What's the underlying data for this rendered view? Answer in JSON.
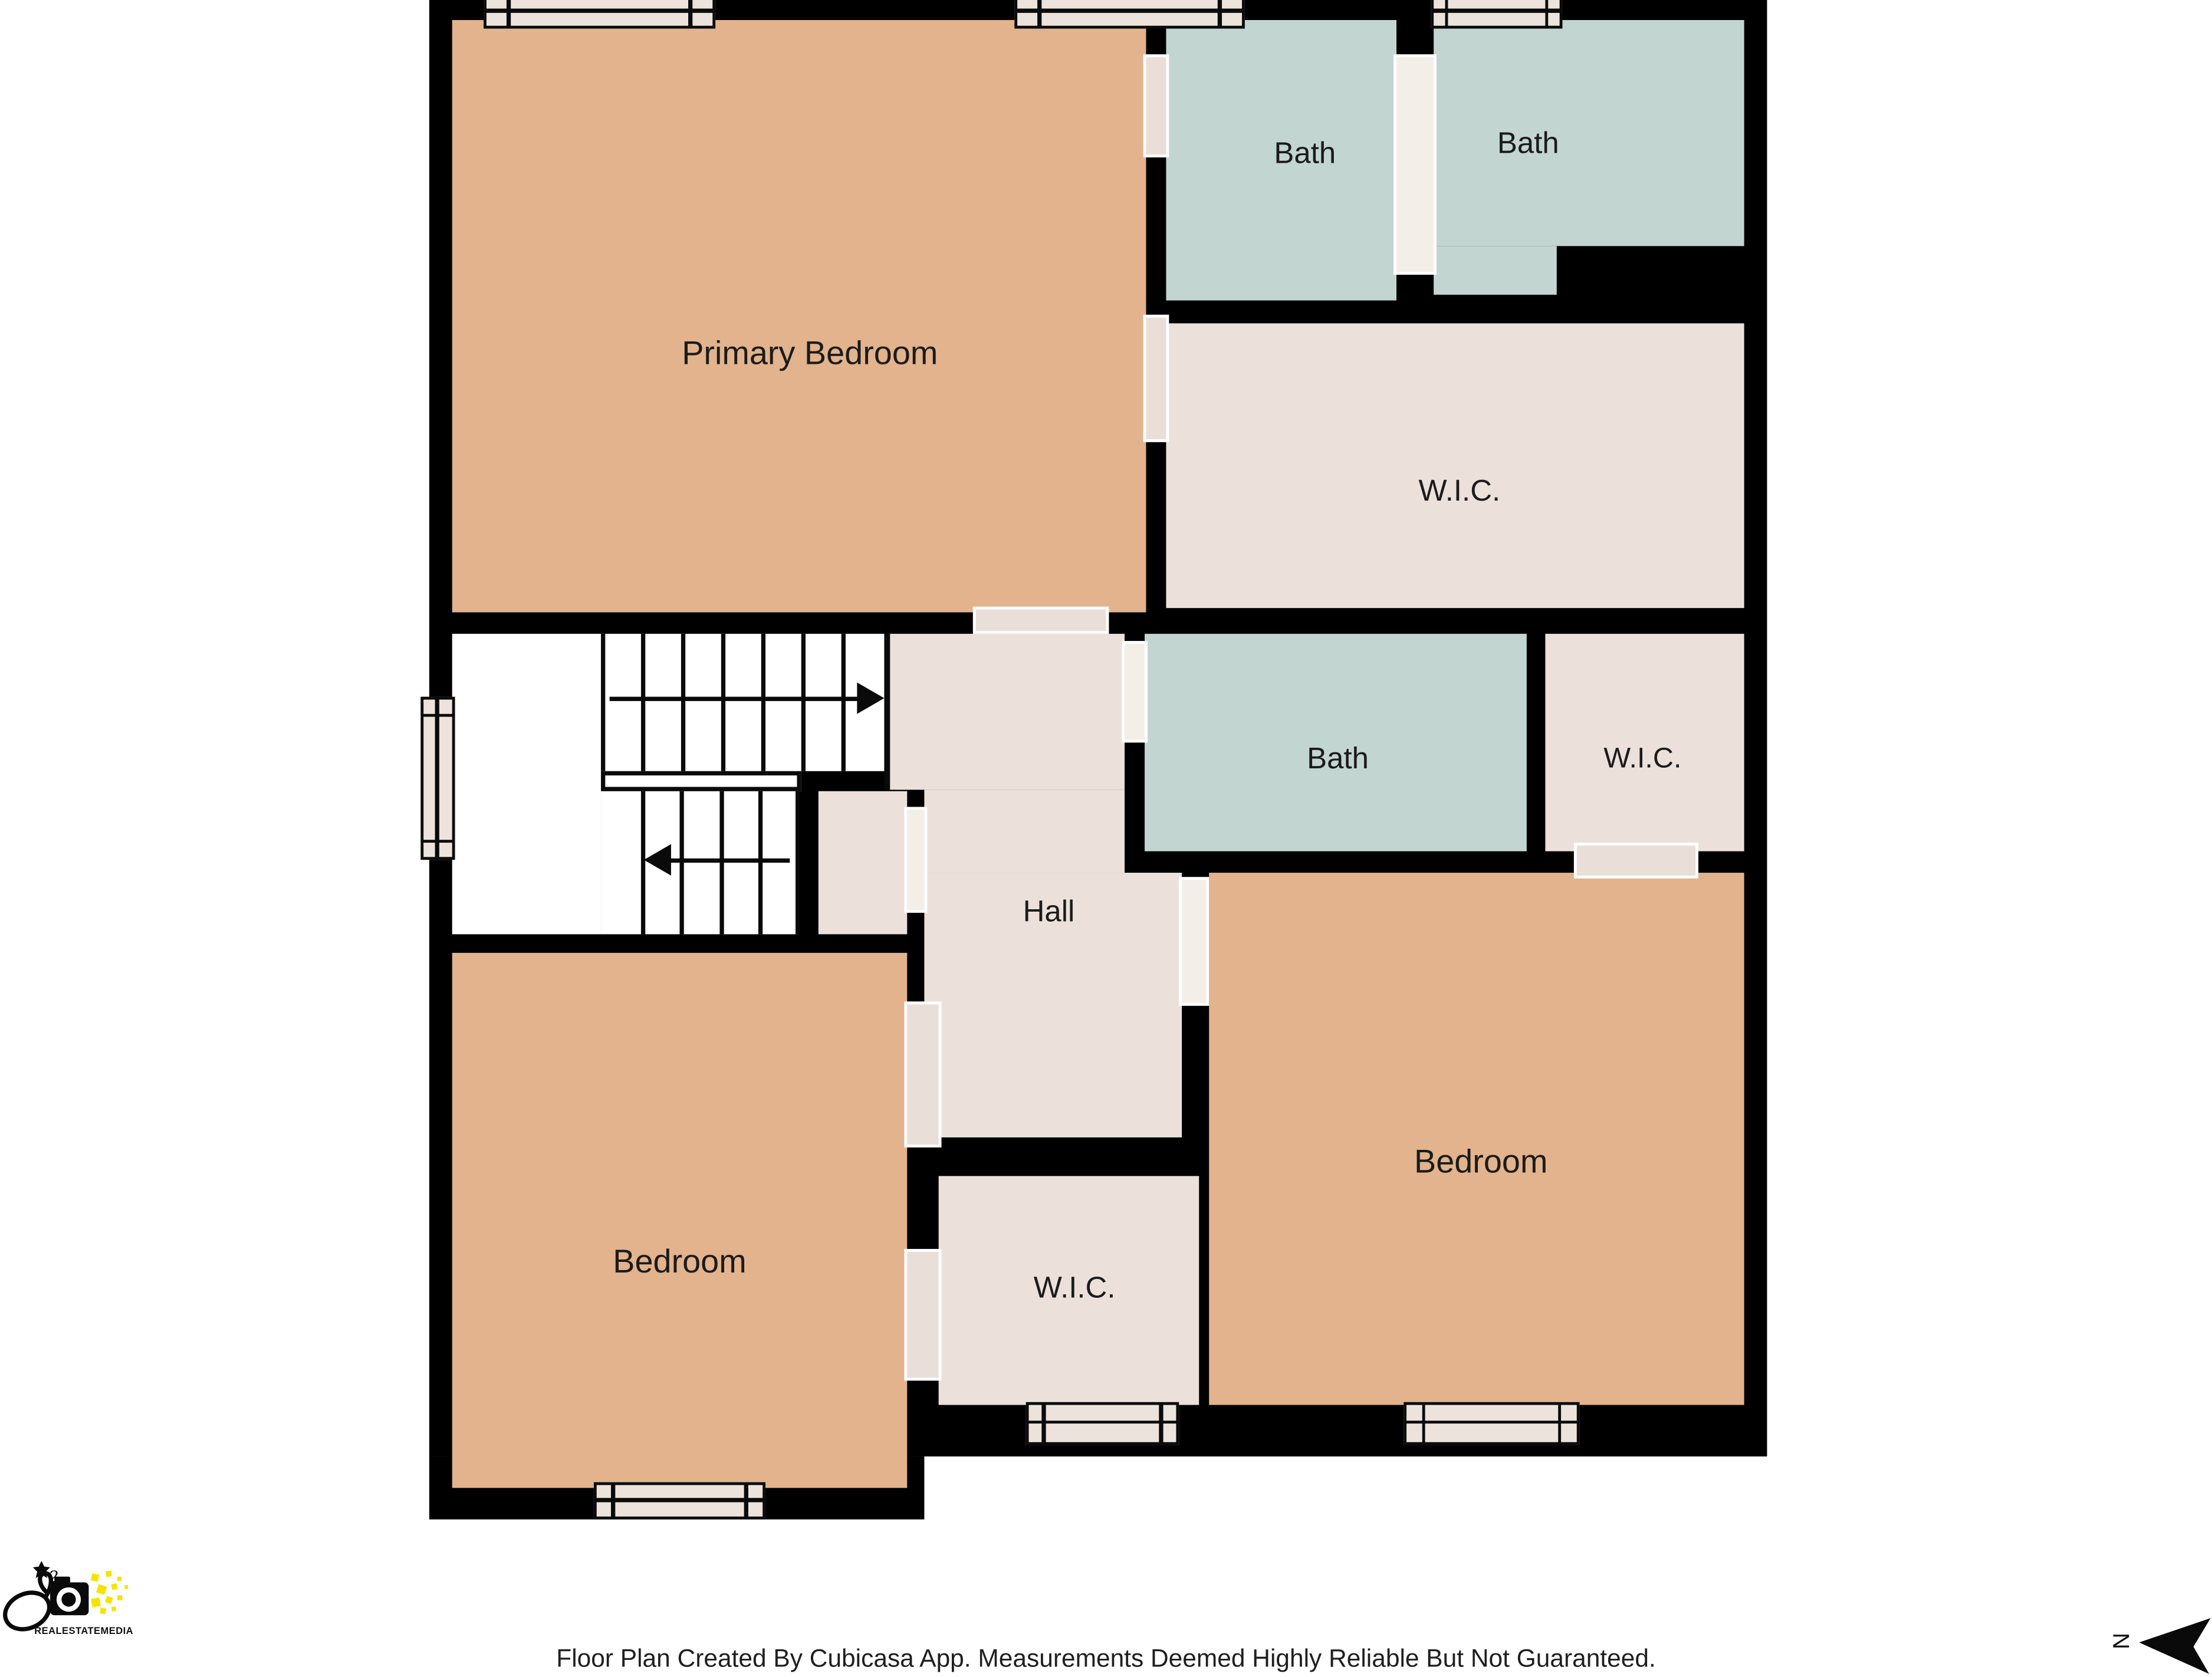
{
  "plan": {
    "rooms": {
      "primary_bedroom": {
        "label": "Primary Bedroom"
      },
      "bath_top_left": {
        "label": "Bath"
      },
      "bath_top_right": {
        "label": "Bath"
      },
      "wic_top": {
        "label": "W.I.C."
      },
      "bath_middle": {
        "label": "Bath"
      },
      "wic_middle": {
        "label": "W.I.C."
      },
      "hall": {
        "label": "Hall"
      },
      "bedroom_left": {
        "label": "Bedroom"
      },
      "wic_bottom": {
        "label": "W.I.C."
      },
      "bedroom_right": {
        "label": "Bedroom"
      }
    },
    "colors": {
      "bedroom": "#e2b38c",
      "bath": "#c2d5d1",
      "closet": "#ebe1da",
      "wall": "#000000",
      "window": "#ece4dc",
      "logo_yellow": "#f6e400"
    },
    "compass": {
      "label": "N"
    }
  },
  "logo": {
    "brand": "REALESTATEMEDIA"
  },
  "footer": {
    "disclaimer": "Floor Plan Created By Cubicasa App. Measurements Deemed Highly Reliable But Not Guaranteed."
  }
}
